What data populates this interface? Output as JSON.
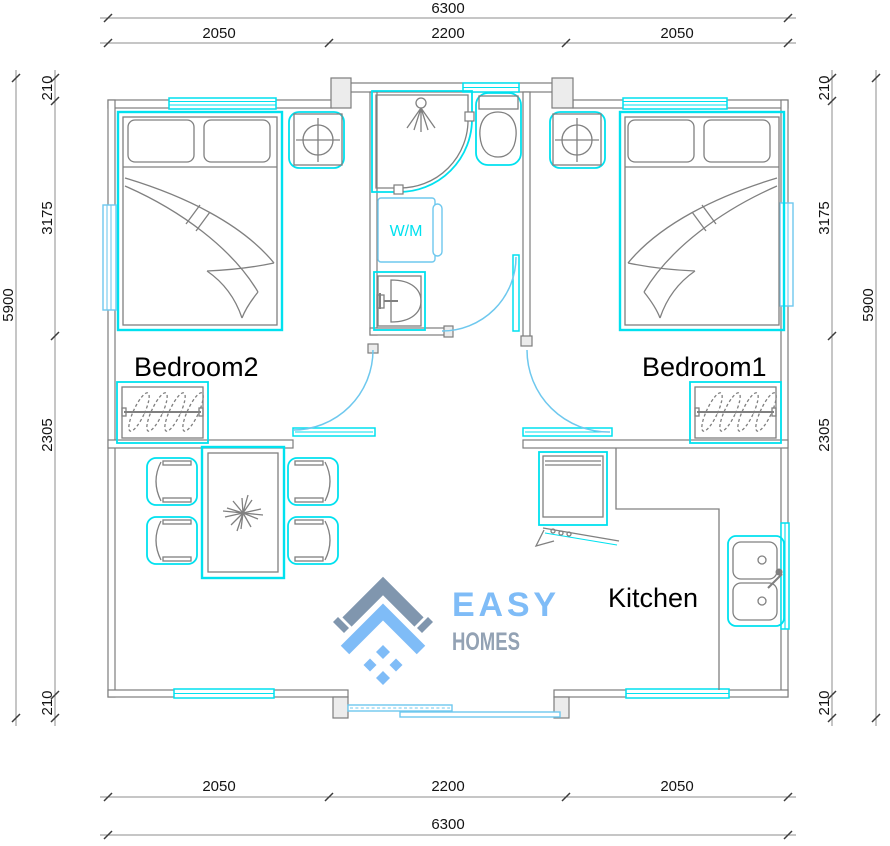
{
  "colors": {
    "cyan": "#00e1ef",
    "doorblue": "#6ec8ee",
    "wall": "#7d7d7d",
    "line": "#808080",
    "dimline": "#8c8c8c",
    "ink": "#141414",
    "logo_blue": "#7fbcf7",
    "logo_gray": "#93a2b4",
    "logo_gray2": "#8096ae"
  },
  "dimensions": {
    "top": {
      "overall": "6300",
      "segments": [
        "2050",
        "2200",
        "2050"
      ]
    },
    "bottom": {
      "overall": "6300",
      "segments": [
        "2050",
        "2200",
        "2050"
      ]
    },
    "left": {
      "overall": "5900",
      "segments": [
        "210",
        "3175",
        "2305",
        "210"
      ]
    },
    "right": {
      "overall": "5900",
      "segments": [
        "210",
        "3175",
        "2305",
        "210"
      ]
    }
  },
  "rooms": {
    "bedroom2": "Bedroom2",
    "bedroom1": "Bedroom1",
    "kitchen": "Kitchen"
  },
  "fixtures": {
    "washing_machine": "W/M"
  },
  "logo": {
    "primary": "EASY",
    "secondary": "HOMES"
  }
}
